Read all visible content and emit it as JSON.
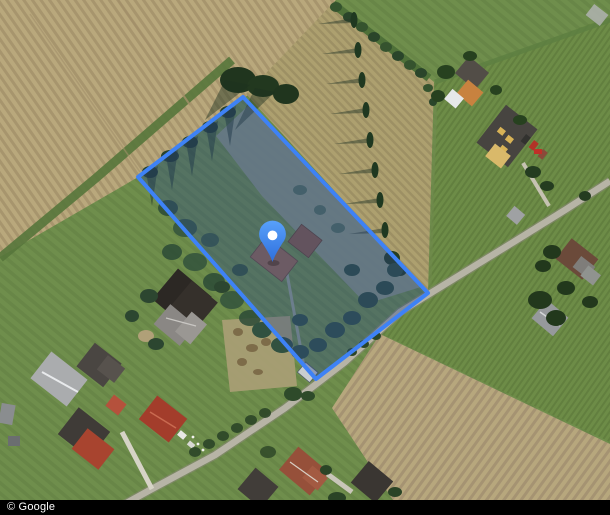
{
  "map": {
    "attribution": "© Google",
    "parcel": {
      "points": "243,97 428,293 316,379 138,177",
      "outline_color": "#3e82f6",
      "fill_tint": "rgba(38,70,138,0.36)"
    },
    "marker": {
      "transform": "translate(272.5,262)",
      "gradient_top": "#59a1fa",
      "gradient_bottom": "#2e6fdd",
      "hole_color": "#ffffff"
    }
  }
}
